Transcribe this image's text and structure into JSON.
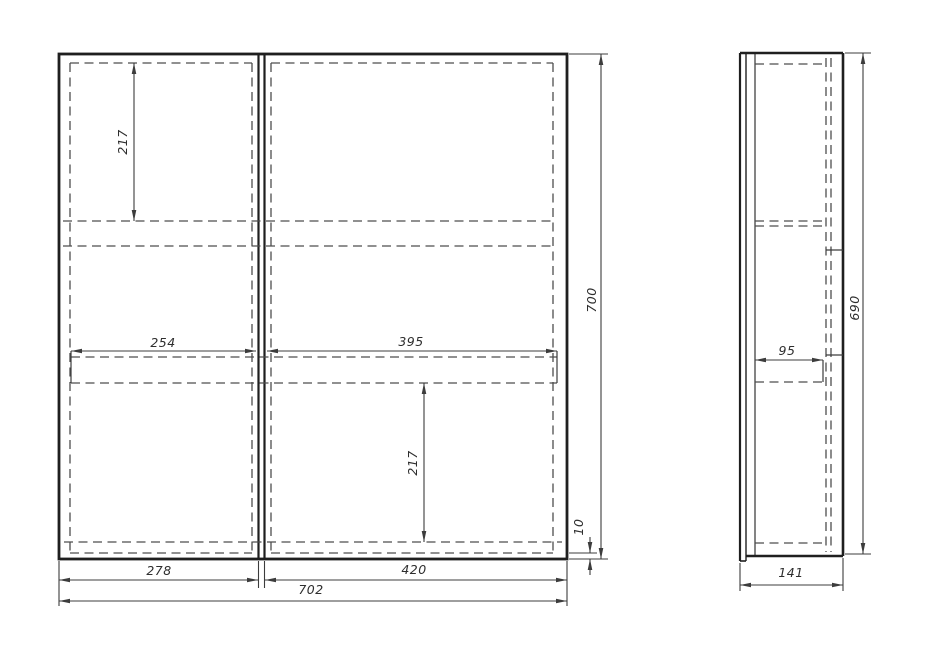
{
  "page": {
    "background": "#ffffff",
    "line_color": "#222222",
    "dashed_color": "#4d4d4d",
    "dim_color": "#3c3c3c",
    "text_color": "#2e2e2e"
  },
  "drawing": {
    "kind": "cabinet-orthographic-technical-drawing",
    "views": [
      {
        "name": "front-view",
        "overall_width": "702",
        "overall_height": "700"
      },
      {
        "name": "side-view",
        "overall_depth": "141",
        "overall_height": "690"
      }
    ]
  },
  "dimensions": [
    {
      "id": "front-top-shelf-offset",
      "view": "front",
      "axis": "vertical",
      "value": "217"
    },
    {
      "id": "front-left-shelf-width",
      "view": "front",
      "axis": "horizontal",
      "value": "254"
    },
    {
      "id": "front-right-shelf-width",
      "view": "front",
      "axis": "horizontal",
      "value": "395"
    },
    {
      "id": "front-bottom-shelf-offset",
      "view": "front",
      "axis": "vertical",
      "value": "217"
    },
    {
      "id": "front-overall-height",
      "view": "front",
      "axis": "vertical",
      "value": "700"
    },
    {
      "id": "front-bottom-gap",
      "view": "front",
      "axis": "vertical",
      "value": "10"
    },
    {
      "id": "front-left-door-width",
      "view": "front",
      "axis": "horizontal",
      "value": "278"
    },
    {
      "id": "front-right-door-width",
      "view": "front",
      "axis": "horizontal",
      "value": "420"
    },
    {
      "id": "front-overall-width",
      "view": "front",
      "axis": "horizontal",
      "value": "702"
    },
    {
      "id": "side-shelf-depth",
      "view": "side",
      "axis": "horizontal",
      "value": "95"
    },
    {
      "id": "side-overall-height",
      "view": "side",
      "axis": "vertical",
      "value": "690"
    },
    {
      "id": "side-overall-depth",
      "view": "side",
      "axis": "horizontal",
      "value": "141"
    }
  ]
}
